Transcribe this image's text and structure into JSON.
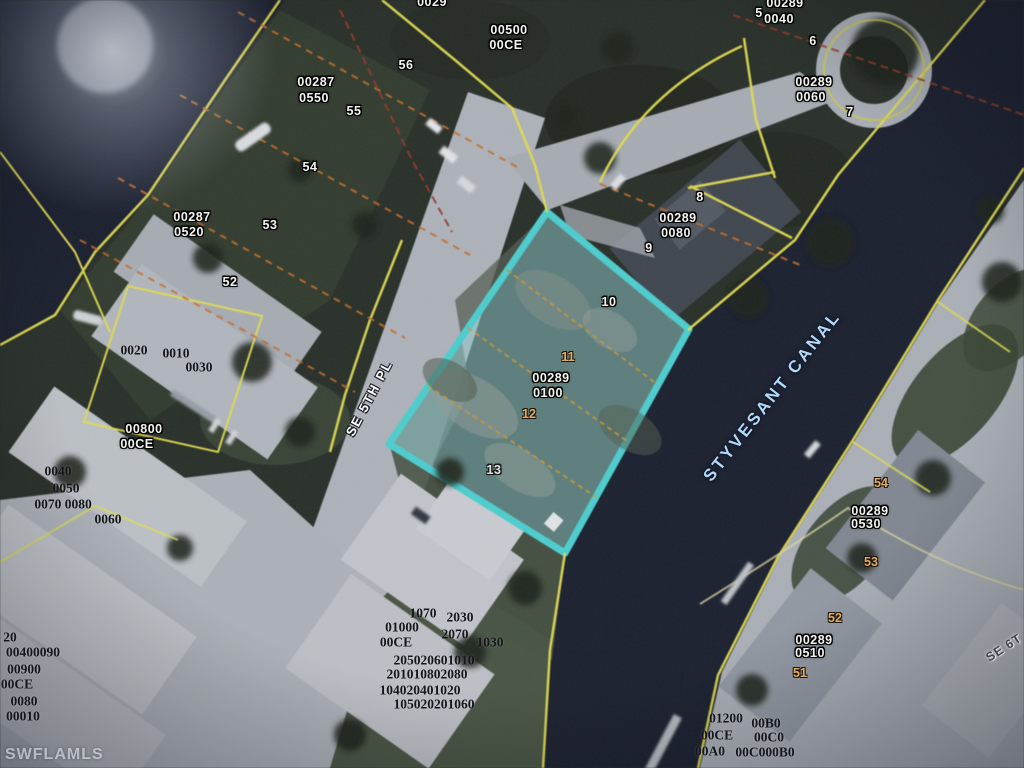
{
  "map": {
    "type": "aerial-parcel-map",
    "watermark": "SWFLAMLS",
    "canal_name": "STYVESANT CANAL",
    "streets": [
      "SE 5TH PL",
      "SE 6T"
    ],
    "highlighted_parcel": {
      "strap": "00289 0100",
      "lot_numbers": [
        "10",
        "11",
        "12",
        "13"
      ],
      "outline_color": "#45d8d6"
    },
    "colors": {
      "parcel_line": "#ece642",
      "lot_line": "#cf6f1f",
      "highlight": "#45d8d6",
      "canal_text": "#b3d9f6",
      "water": "#191d2b"
    },
    "labels": [
      {
        "text": "0029",
        "x": 432,
        "y": 2,
        "style": "id"
      },
      {
        "text": "00500",
        "x": 509,
        "y": 30,
        "style": "id"
      },
      {
        "text": "00CE",
        "x": 506,
        "y": 45,
        "style": "id"
      },
      {
        "text": "56",
        "x": 406,
        "y": 65,
        "style": "id"
      },
      {
        "text": "00287",
        "x": 316,
        "y": 82,
        "style": "id"
      },
      {
        "text": "0550",
        "x": 314,
        "y": 98,
        "style": "id"
      },
      {
        "text": "55",
        "x": 354,
        "y": 111,
        "style": "id"
      },
      {
        "text": "54",
        "x": 310,
        "y": 167,
        "style": "id"
      },
      {
        "text": "00287",
        "x": 192,
        "y": 217,
        "style": "id"
      },
      {
        "text": "0520",
        "x": 189,
        "y": 232,
        "style": "id"
      },
      {
        "text": "53",
        "x": 270,
        "y": 225,
        "style": "id"
      },
      {
        "text": "52",
        "x": 230,
        "y": 282,
        "style": "id"
      },
      {
        "text": "00800",
        "x": 144,
        "y": 429,
        "style": "id"
      },
      {
        "text": "00CE",
        "x": 137,
        "y": 444,
        "style": "id"
      },
      {
        "text": "5",
        "x": 759,
        "y": 13,
        "style": "id"
      },
      {
        "text": "00289",
        "x": 785,
        "y": 3,
        "style": "id"
      },
      {
        "text": "0040",
        "x": 779,
        "y": 19,
        "style": "id"
      },
      {
        "text": "6",
        "x": 813,
        "y": 41,
        "style": "id"
      },
      {
        "text": "00289",
        "x": 814,
        "y": 82,
        "style": "id"
      },
      {
        "text": "0060",
        "x": 811,
        "y": 97,
        "style": "id"
      },
      {
        "text": "7",
        "x": 850,
        "y": 112,
        "style": "id"
      },
      {
        "text": "8",
        "x": 700,
        "y": 197,
        "style": "id"
      },
      {
        "text": "00289",
        "x": 678,
        "y": 218,
        "style": "id"
      },
      {
        "text": "0080",
        "x": 676,
        "y": 233,
        "style": "id"
      },
      {
        "text": "9",
        "x": 649,
        "y": 248,
        "style": "id"
      },
      {
        "text": "10",
        "x": 609,
        "y": 302,
        "style": "id"
      },
      {
        "text": "00289",
        "x": 551,
        "y": 378,
        "style": "id"
      },
      {
        "text": "0100",
        "x": 548,
        "y": 393,
        "style": "id"
      },
      {
        "text": "13",
        "x": 494,
        "y": 470,
        "style": "id",
        "op": 0.85
      },
      {
        "text": "00289",
        "x": 870,
        "y": 511,
        "style": "id"
      },
      {
        "text": "0530",
        "x": 866,
        "y": 524,
        "style": "id"
      },
      {
        "text": "00289",
        "x": 814,
        "y": 640,
        "style": "id"
      },
      {
        "text": "0510",
        "x": 810,
        "y": 653,
        "style": "id"
      },
      {
        "text": "11",
        "x": 568,
        "y": 357,
        "style": "or"
      },
      {
        "text": "12",
        "x": 529,
        "y": 414,
        "style": "or"
      },
      {
        "text": "54",
        "x": 881,
        "y": 483,
        "style": "or"
      },
      {
        "text": "53",
        "x": 871,
        "y": 562,
        "style": "or"
      },
      {
        "text": "52",
        "x": 835,
        "y": 618,
        "style": "or"
      },
      {
        "text": "51",
        "x": 800,
        "y": 673,
        "style": "or"
      },
      {
        "text": "0020",
        "x": 134,
        "y": 350,
        "style": "bk"
      },
      {
        "text": "0010",
        "x": 176,
        "y": 353,
        "style": "bk"
      },
      {
        "text": "0030",
        "x": 199,
        "y": 367,
        "style": "bk"
      },
      {
        "text": "0040",
        "x": 58,
        "y": 471,
        "style": "bk"
      },
      {
        "text": "0050",
        "x": 66,
        "y": 488,
        "style": "bk"
      },
      {
        "text": "0070 0080",
        "x": 63,
        "y": 504,
        "style": "bk"
      },
      {
        "text": "0060",
        "x": 108,
        "y": 519,
        "style": "bk"
      },
      {
        "text": "1070",
        "x": 423,
        "y": 613,
        "style": "bk"
      },
      {
        "text": "2030",
        "x": 460,
        "y": 617,
        "style": "bk"
      },
      {
        "text": "01000",
        "x": 402,
        "y": 627,
        "style": "bk"
      },
      {
        "text": "2070",
        "x": 455,
        "y": 634,
        "style": "bk"
      },
      {
        "text": "00CE",
        "x": 396,
        "y": 642,
        "style": "bk"
      },
      {
        "text": "1030",
        "x": 490,
        "y": 642,
        "style": "bk"
      },
      {
        "text": "205020601010",
        "x": 434,
        "y": 660,
        "style": "bk"
      },
      {
        "text": "201010802080",
        "x": 427,
        "y": 674,
        "style": "bk"
      },
      {
        "text": "104020401020",
        "x": 420,
        "y": 690,
        "style": "bk"
      },
      {
        "text": "105020201060",
        "x": 434,
        "y": 704,
        "style": "bk"
      },
      {
        "text": "20",
        "x": 10,
        "y": 637,
        "style": "bk"
      },
      {
        "text": "00400090",
        "x": 33,
        "y": 652,
        "style": "bk"
      },
      {
        "text": "00900",
        "x": 24,
        "y": 669,
        "style": "bk"
      },
      {
        "text": "00CE",
        "x": 17,
        "y": 684,
        "style": "bk"
      },
      {
        "text": "0080",
        "x": 24,
        "y": 701,
        "style": "bk"
      },
      {
        "text": "00010",
        "x": 23,
        "y": 716,
        "style": "bk"
      },
      {
        "text": "01200",
        "x": 726,
        "y": 718,
        "style": "bk"
      },
      {
        "text": "00B0",
        "x": 766,
        "y": 723,
        "style": "bk"
      },
      {
        "text": "00CE",
        "x": 717,
        "y": 735,
        "style": "bk"
      },
      {
        "text": "00C0",
        "x": 769,
        "y": 737,
        "style": "bk"
      },
      {
        "text": "00A0",
        "x": 710,
        "y": 751,
        "style": "bk"
      },
      {
        "text": "00C000B0",
        "x": 765,
        "y": 752,
        "style": "bk"
      },
      {
        "text": "STYVESANT CANAL",
        "x": 772,
        "y": 396,
        "style": "canal",
        "rot": -52
      },
      {
        "text": "SE 5TH PL",
        "x": 369,
        "y": 398,
        "style": "stl",
        "rot": -62
      },
      {
        "text": "SE 6T",
        "x": 1004,
        "y": 648,
        "style": "std",
        "rot": -33
      }
    ]
  }
}
